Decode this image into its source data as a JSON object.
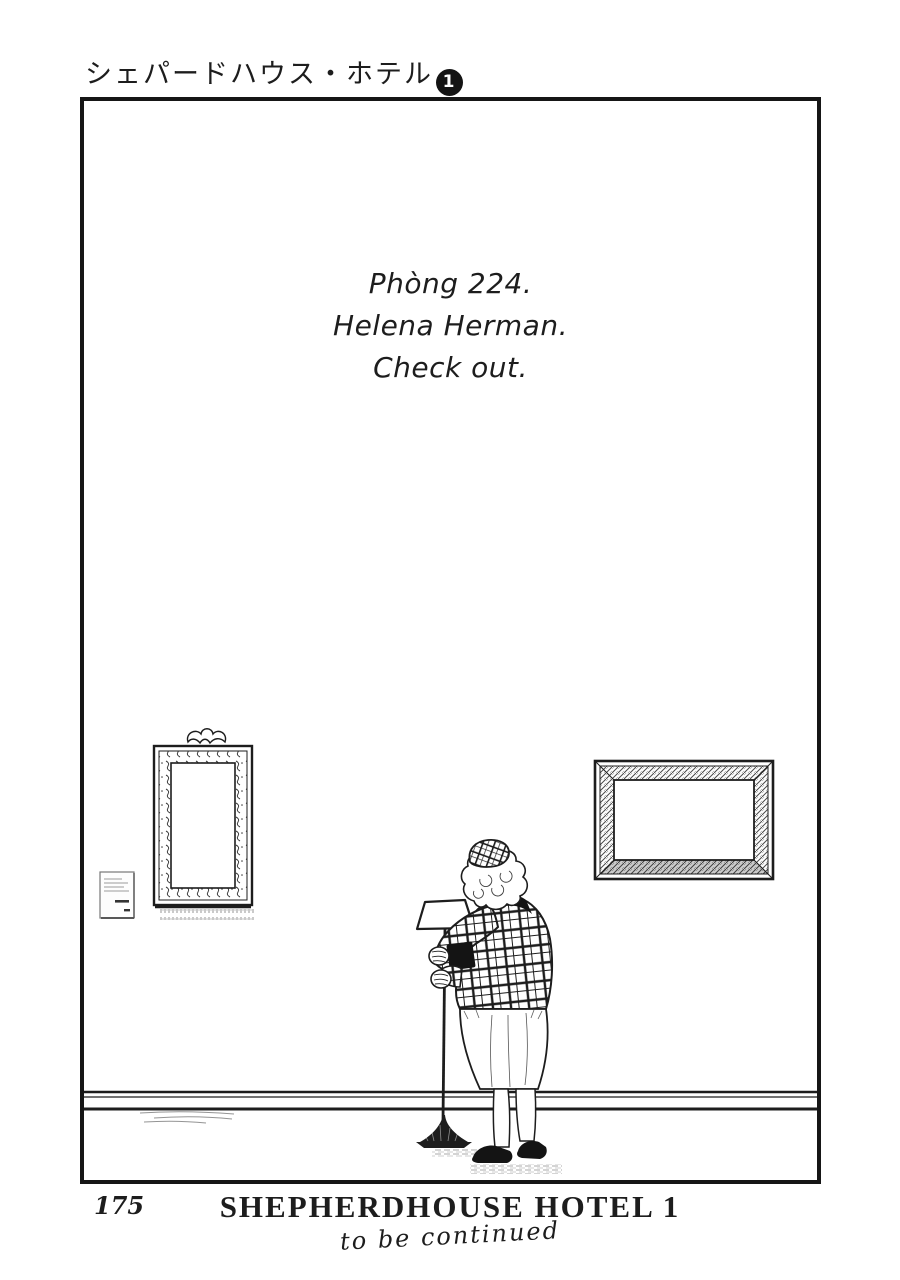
{
  "header": {
    "series_title_jp": "シェパードハウス・ホテル",
    "volume_number": "1"
  },
  "panel": {
    "caption_lines": [
      "Phòng 224.",
      "Helena Herman.",
      "Check out."
    ]
  },
  "artwork": {
    "scene": "elderly woman in plaid jacket and hat standing in a gallery hallway holding a floor lamp, two empty picture frames on the wall, small placard",
    "elements": [
      "ornate-empty-frame",
      "wall-placard",
      "beveled-empty-frame",
      "floor-lamp",
      "woman-figure",
      "baseboard"
    ]
  },
  "footer": {
    "page_number": "175",
    "book_title": "SHEPHERDHOUSE HOTEL 1",
    "continued_note": "to be continued"
  },
  "colors": {
    "ink": "#1d1d1d",
    "paper": "#ffffff"
  }
}
